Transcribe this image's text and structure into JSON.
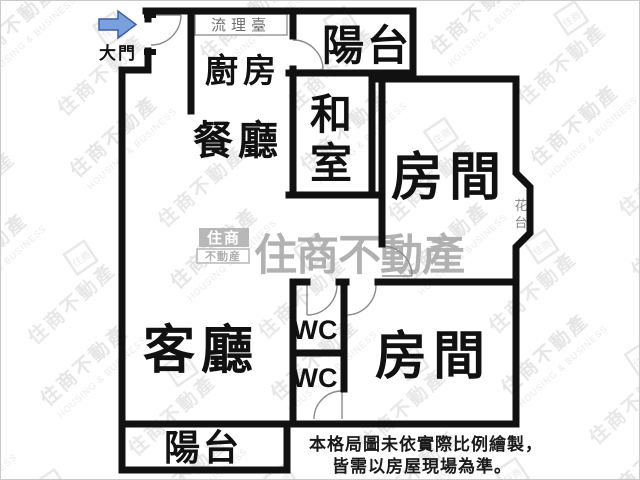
{
  "plan": {
    "entry": {
      "label": "大門"
    },
    "rooms": {
      "counter": "流理臺",
      "kitchen": "廚房",
      "dining": "餐廳",
      "balcony_top": "陽台",
      "washitsu_char1": "和",
      "washitsu_char2": "室",
      "bedroom_top": "房間",
      "flower_char1": "花",
      "flower_char2": "台",
      "living": "客廳",
      "wc_top": "WC",
      "wc_bottom": "WC",
      "bedroom_bottom": "房間",
      "balcony_bottom": "陽台"
    },
    "disclaimer": {
      "line1": "本格局圖未依實際比例繪製，",
      "line2": "皆需以房屋現場為準。"
    },
    "watermark": {
      "brand": "住商不動產",
      "brand_en": "HOUSING & BUSINESS",
      "logo_top": "住商",
      "logo_bottom": "不動産"
    },
    "colors": {
      "wall": "#111111",
      "door": "#777777",
      "muted": "#808080",
      "arrow_fill": "#7ba1dd",
      "arrow_stroke": "#3c5fa8",
      "watermark_dark": "#ababab",
      "watermark_light": "#d0d0d0"
    }
  }
}
